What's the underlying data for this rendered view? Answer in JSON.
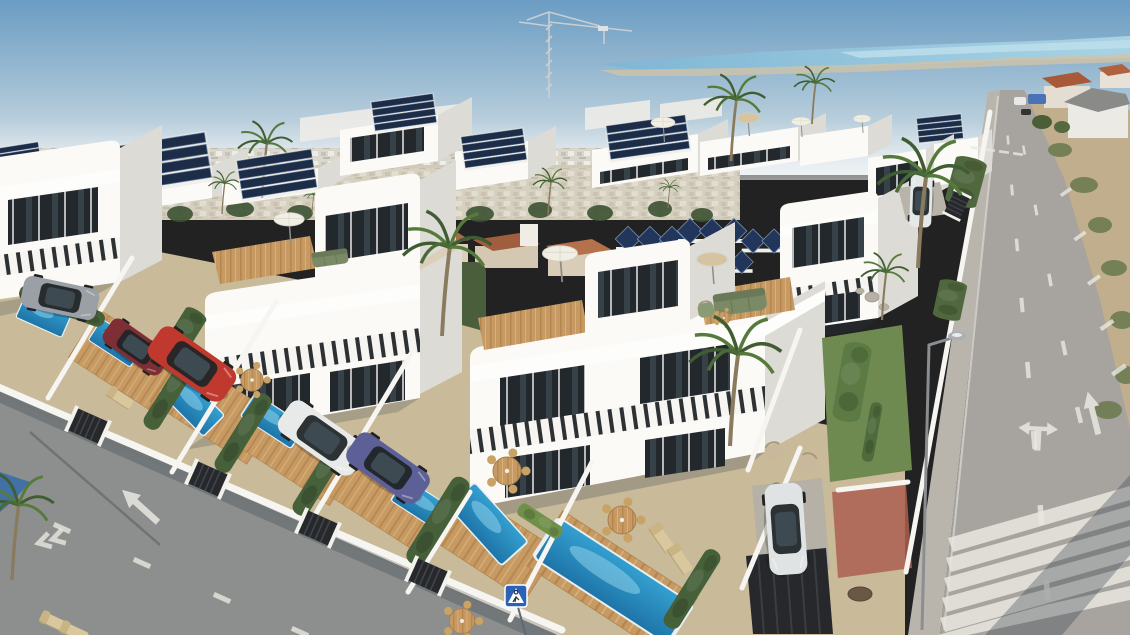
{
  "meta": {
    "description": "Aerial 3D architectural render of a modern white villa development with rooftop solar panels, roof terraces, private pools, parked cars, a long asphalt road with lane arrows and a zebra crossing on the right, and a distant blue coastal lagoon on the horizon.",
    "view": "aerial three-quarter",
    "visible_text": ""
  },
  "palette": {
    "sky_top": "#6B9CC3",
    "sky_mid": "#A7C3D6",
    "horizon": "#E2E8EA",
    "sea": "#8FC2DA",
    "sea_light": "#B2DAE8",
    "shore": "#CFC3A8",
    "city": "#D8D4C8",
    "field": "#7C8A5E",
    "tree_dark": "#3C5232",
    "tan_ground": "#C9BA9A",
    "terracotta": "#AC6A48",
    "road_right": "#A7A4A0",
    "road_left": "#8D8F8E",
    "sidewalk": "#B9B5AC",
    "red_paving": "#AD5F50",
    "sand": "#C2AE8C",
    "villa_white": "#F6F5F1",
    "villa_lit": "#FBFAF7",
    "villa_shade": "#DCDBD5",
    "villa_dark": "#C9C8C1",
    "glass": "#23282C",
    "glass_hi": "#46565F",
    "frame": "#1A1D1F",
    "rail_dark": "#2E3134",
    "wood": "#C79A63",
    "wood_dark": "#B3874F",
    "pool_light": "#2F98C8",
    "pool_deep": "#1E74A8",
    "pool_hi": "#8ED1EA",
    "hedge": "#46603A",
    "grass": "#6A8A47",
    "palm_dark": "#3F5C33",
    "palm_light": "#567A3C",
    "trunk": "#8A7A5E",
    "parasol_white": "#F1EEE4",
    "parasol_tan": "#D8C49C",
    "sofa_green": "#7B8A66",
    "beige": "#C9B89B",
    "solar": "#1D2C47",
    "solar_line": "#5D7696",
    "car_red": "#C0392E",
    "car_maroon": "#7E2F35",
    "car_silver": "#9AA0A6",
    "car_blue": "#5C6096",
    "car_white": "#E8EAEA",
    "shadow": "#2F3C49",
    "marking": "#E9E7E0",
    "sign_blue": "#2B62B8",
    "crane": "#C8CED2"
  },
  "scene_counts": {
    "foreground_villas": 4,
    "back_row_villas": 7,
    "pools": 7,
    "cars": 7,
    "solar_arrays": 12,
    "palm_trees": 15
  },
  "sprites": [
    {
      "k": "palm",
      "x": 40,
      "y": 224,
      "sx": 0.3,
      "l": "back"
    },
    {
      "k": "palm",
      "x": 135,
      "y": 220,
      "sx": 0.3,
      "l": "back"
    },
    {
      "k": "palm",
      "x": 312,
      "y": 214,
      "sx": 0.28,
      "l": "back"
    },
    {
      "k": "palm",
      "x": 668,
      "y": 208,
      "sx": 0.3,
      "l": "back"
    },
    {
      "k": "palm",
      "x": 100,
      "y": 248,
      "sx": 0.5,
      "l": "mid"
    },
    {
      "k": "palm",
      "x": 222,
      "y": 214,
      "sx": 0.45,
      "l": "mid"
    },
    {
      "k": "palm",
      "x": 262,
      "y": 198,
      "sx": 0.8,
      "l": "mid"
    },
    {
      "k": "palm",
      "x": 548,
      "y": 216,
      "sx": 0.5,
      "l": "mid"
    },
    {
      "k": "palm",
      "x": 731,
      "y": 161,
      "sx": 0.9,
      "l": "mid"
    },
    {
      "k": "palm",
      "x": 812,
      "y": 124,
      "sx": 0.6,
      "l": "mid"
    },
    {
      "k": "solar",
      "x": 18,
      "y": 158,
      "sx": 0.5,
      "r": -9,
      "l": "mid"
    },
    {
      "k": "solar",
      "x": 158,
      "y": 164,
      "sx": 1.15,
      "sy": 0.95,
      "r": -9,
      "l": "mid"
    },
    {
      "k": "solar",
      "x": 277,
      "y": 175,
      "sx": 0.85,
      "sy": 0.8,
      "r": -9,
      "l": "mid"
    },
    {
      "k": "solar",
      "x": 404,
      "y": 113,
      "sx": 0.7,
      "sy": 0.6,
      "r": -8,
      "l": "mid"
    },
    {
      "k": "solar",
      "x": 494,
      "y": 149,
      "sx": 0.7,
      "sy": 0.65,
      "r": -8,
      "l": "mid"
    },
    {
      "k": "solar",
      "x": 648,
      "y": 138,
      "sx": 0.9,
      "sy": 0.7,
      "r": -8,
      "l": "mid"
    },
    {
      "k": "solar",
      "x": 940,
      "y": 129,
      "sx": 0.5,
      "sy": 0.5,
      "r": -6,
      "l": "mid"
    },
    {
      "k": "solarzig",
      "x": 650,
      "y": 239,
      "sx": 1,
      "l": "mid"
    },
    {
      "k": "solarzig",
      "x": 712,
      "y": 231,
      "sx": 1,
      "l": "mid"
    },
    {
      "k": "solarzig",
      "x": 774,
      "y": 241,
      "sx": 0.95,
      "l": "mid"
    },
    {
      "k": "solarzig",
      "x": 658,
      "y": 269,
      "sx": 0.95,
      "l": "mid"
    },
    {
      "k": "solarzig",
      "x": 722,
      "y": 262,
      "sx": 0.9,
      "l": "mid"
    },
    {
      "k": "parasol",
      "x": 663,
      "y": 142,
      "sx": 0.75,
      "l": "mid"
    },
    {
      "k": "parasol",
      "x": 748,
      "y": 136,
      "sx": 0.7,
      "c": "#D8C49C",
      "l": "mid"
    },
    {
      "k": "parasol",
      "x": 801,
      "y": 137,
      "sx": 0.6,
      "l": "mid"
    },
    {
      "k": "parasol",
      "x": 862,
      "y": 133,
      "sx": 0.55,
      "l": "mid"
    },
    {
      "k": "deck",
      "x": 128,
      "y": 362,
      "sx": 1.05,
      "sy": 0.95,
      "r": 33,
      "l": "decks"
    },
    {
      "k": "deck",
      "x": 214,
      "y": 409,
      "sx": 1.15,
      "sy": 0.95,
      "r": 33,
      "l": "decks"
    },
    {
      "k": "deck",
      "x": 298,
      "y": 453,
      "sx": 1.1,
      "sy": 0.9,
      "r": 33,
      "l": "decks"
    },
    {
      "k": "deck",
      "x": 384,
      "y": 499,
      "sx": 1.1,
      "sy": 0.9,
      "r": 33,
      "l": "decks"
    },
    {
      "k": "deck",
      "x": 489,
      "y": 541,
      "sx": 1.25,
      "sy": 1.0,
      "r": 33,
      "l": "decks"
    },
    {
      "k": "deck",
      "x": 612,
      "y": 582,
      "sx": 1.6,
      "sy": 1.1,
      "r": 33,
      "l": "decks"
    },
    {
      "k": "pool",
      "x": 44,
      "y": 315,
      "sx": 0.5,
      "sy": 0.45,
      "r": 24,
      "l": "pools"
    },
    {
      "k": "pool",
      "x": 116,
      "y": 343,
      "sx": 0.5,
      "sy": 0.42,
      "r": 33,
      "l": "pools"
    },
    {
      "k": "pool",
      "x": 192,
      "y": 404,
      "sx": 0.62,
      "sy": 0.5,
      "r": 45,
      "l": "pools"
    },
    {
      "k": "pool",
      "x": 273,
      "y": 421,
      "sx": 0.6,
      "sy": 0.45,
      "r": 33,
      "l": "pools"
    },
    {
      "k": "pool",
      "x": 424,
      "y": 506,
      "sx": 0.62,
      "sy": 0.45,
      "r": 33,
      "l": "pools"
    },
    {
      "k": "pool",
      "x": 488,
      "y": 524,
      "sx": 0.8,
      "sy": 0.6,
      "r": 48,
      "l": "pools"
    },
    {
      "k": "pool",
      "x": 613,
      "y": 581,
      "sx": 1.6,
      "sy": 0.8,
      "r": 33,
      "l": "pools"
    },
    {
      "k": "hedge",
      "x": 62,
      "y": 306,
      "sx": 0.9,
      "sy": 0.8,
      "r": 20
    },
    {
      "k": "hedge",
      "x": 185,
      "y": 332,
      "sx": 0.5,
      "sy": 1.2,
      "r": -58
    },
    {
      "k": "hedge",
      "x": 172,
      "y": 390,
      "sx": 0.9,
      "r": -58
    },
    {
      "k": "hedge",
      "x": 243,
      "y": 433,
      "sx": 0.9,
      "r": -58
    },
    {
      "k": "hedge",
      "x": 321,
      "y": 476,
      "sx": 0.9,
      "r": -58
    },
    {
      "k": "hedge",
      "x": 438,
      "y": 521,
      "sx": 1.0,
      "r": -58
    },
    {
      "k": "hedge",
      "x": 692,
      "y": 589,
      "sx": 0.9,
      "r": -58
    },
    {
      "k": "hedge",
      "x": 152,
      "y": 352,
      "sx": 0.6,
      "sy": 0.8,
      "r": 33,
      "c": "#6A8A47"
    },
    {
      "k": "hedge",
      "x": 540,
      "y": 521,
      "sx": 0.5,
      "sy": 0.7,
      "r": 33,
      "c": "#6F9049"
    },
    {
      "k": "hedge",
      "x": 852,
      "y": 382,
      "sx": 0.8,
      "sy": 1.4,
      "r": -80,
      "c": "#5C7A44"
    },
    {
      "k": "hedge",
      "x": 872,
      "y": 432,
      "sx": 0.6,
      "r": -80,
      "c": "#4F6B3C"
    },
    {
      "k": "hedge",
      "x": 966,
      "y": 182,
      "sx": 0.5,
      "sy": 1.6,
      "r": -75,
      "c": "#50683E"
    },
    {
      "k": "hedge",
      "x": 950,
      "y": 300,
      "sx": 0.4,
      "sy": 1.4,
      "r": -78,
      "c": "#50683E"
    },
    {
      "k": "stone",
      "x": 872,
      "y": 297,
      "sx": 1
    },
    {
      "k": "stone",
      "x": 884,
      "y": 307,
      "sx": 0.7
    },
    {
      "k": "stone",
      "x": 860,
      "y": 291,
      "sx": 0.6
    },
    {
      "k": "parasol",
      "x": 289,
      "y": 244,
      "sx": 0.95
    },
    {
      "k": "parasol",
      "x": 560,
      "y": 282,
      "sx": 1.1
    },
    {
      "k": "parasol",
      "x": 712,
      "y": 284,
      "sx": 0.95,
      "c": "#D8C49C"
    },
    {
      "k": "sofa",
      "x": 740,
      "y": 302,
      "sx": 1.1,
      "r": -8
    },
    {
      "k": "armchair",
      "x": 706,
      "y": 310,
      "sx": 0.8,
      "r": -8,
      "c": "#8A9A74"
    },
    {
      "k": "table",
      "x": 724,
      "y": 318,
      "sx": 0.45
    },
    {
      "k": "sofa",
      "x": 330,
      "y": 258,
      "sx": 0.75,
      "r": -8
    },
    {
      "k": "table",
      "x": 252,
      "y": 380,
      "sx": 0.8
    },
    {
      "k": "table",
      "x": 507,
      "y": 471,
      "sx": 1.0
    },
    {
      "k": "table",
      "x": 622,
      "y": 520,
      "sx": 1.0
    },
    {
      "k": "table",
      "x": 462,
      "y": 621,
      "sx": 0.9
    },
    {
      "k": "lounger",
      "x": 318,
      "y": 447,
      "sx": 0.9,
      "r": 33
    },
    {
      "k": "lounger",
      "x": 336,
      "y": 460,
      "sx": 0.9,
      "r": 33
    },
    {
      "k": "lounger",
      "x": 662,
      "y": 538,
      "sx": 0.95,
      "r": 55
    },
    {
      "k": "lounger",
      "x": 680,
      "y": 559,
      "sx": 0.95,
      "r": 55
    },
    {
      "k": "lounger",
      "x": 54,
      "y": 622,
      "sx": 0.9,
      "r": 25
    },
    {
      "k": "lounger",
      "x": 74,
      "y": 632,
      "sx": 0.9,
      "r": 25
    },
    {
      "k": "lounger",
      "x": 120,
      "y": 398,
      "sx": 0.85,
      "r": 33
    },
    {
      "k": "armchair",
      "x": 774,
      "y": 452,
      "sx": 0.9,
      "r": -15
    },
    {
      "k": "armchair",
      "x": 808,
      "y": 463,
      "sx": 0.9,
      "r": 15
    },
    {
      "k": "gate",
      "x": 88,
      "y": 426,
      "r": 24
    },
    {
      "k": "gate",
      "x": 208,
      "y": 479,
      "r": 24
    },
    {
      "k": "gate",
      "x": 318,
      "y": 528,
      "r": 24
    },
    {
      "k": "gate",
      "x": 428,
      "y": 576,
      "r": 24
    },
    {
      "k": "gate",
      "x": 957,
      "y": 205,
      "sx": 0.7,
      "r": -64
    },
    {
      "k": "car",
      "n": "silver-coupe",
      "x": 60,
      "y": 298,
      "sx": 0.8,
      "r": 12,
      "c": "#9AA0A6"
    },
    {
      "k": "car",
      "n": "maroon-car",
      "x": 136,
      "y": 347,
      "sx": 0.72,
      "r": 35,
      "c": "#7E2F35"
    },
    {
      "k": "car",
      "n": "red-suv",
      "x": 192,
      "y": 364,
      "sx": 0.95,
      "r": 35,
      "c": "#C0392E"
    },
    {
      "k": "car",
      "n": "white-sedan",
      "x": 322,
      "y": 438,
      "sx": 0.95,
      "r": 35,
      "c": "#E8EAEA"
    },
    {
      "k": "car",
      "n": "blue-coupe",
      "x": 388,
      "y": 468,
      "sx": 0.9,
      "r": 35,
      "c": "#5C6096"
    },
    {
      "k": "car",
      "n": "white-suv",
      "x": 786,
      "y": 529,
      "sx": 0.95,
      "r": 86,
      "c": "#DFE3E4"
    },
    {
      "k": "car",
      "n": "white-compact",
      "x": 921,
      "y": 201,
      "sx": 0.55,
      "r": -88,
      "c": "#E5E8E8"
    },
    {
      "k": "palm",
      "x": 442,
      "y": 336,
      "sx": 1.3
    },
    {
      "k": "palm",
      "x": 730,
      "y": 446,
      "sx": 1.35
    },
    {
      "k": "palm",
      "x": 918,
      "y": 268,
      "sx": 1.35
    },
    {
      "k": "palm",
      "x": 12,
      "y": 580,
      "sx": 1.1
    },
    {
      "k": "palm",
      "x": 882,
      "y": 320,
      "sx": 0.7
    },
    {
      "k": "arrowup",
      "x": 140,
      "y": 506,
      "sx": 1.1,
      "r": -48
    },
    {
      "k": "chevron",
      "x": 50,
      "y": 540,
      "sx": 1.2,
      "r": -15
    },
    {
      "k": "dash",
      "x": 62,
      "y": 528,
      "r": 24
    },
    {
      "k": "dash",
      "x": 142,
      "y": 563,
      "r": 24
    },
    {
      "k": "dash",
      "x": 222,
      "y": 598,
      "r": 24
    },
    {
      "k": "dash",
      "x": 300,
      "y": 632,
      "r": 24
    },
    {
      "k": "arrowfork",
      "x": 1038,
      "y": 433,
      "sx": 1.1,
      "r": 3
    },
    {
      "k": "arrowup",
      "x": 1093,
      "y": 413,
      "sx": 1.0,
      "r": -14
    },
    {
      "k": "dash",
      "x": 1008,
      "y": 140,
      "sx": 0.5,
      "r": 85
    },
    {
      "k": "dash",
      "x": 1012,
      "y": 190,
      "sx": 0.6,
      "r": 85
    },
    {
      "k": "dash",
      "x": 1017,
      "y": 245,
      "sx": 0.7,
      "r": 85
    },
    {
      "k": "dash",
      "x": 1022,
      "y": 305,
      "sx": 0.8,
      "r": 85
    },
    {
      "k": "dash",
      "x": 1028,
      "y": 370,
      "sx": 0.9,
      "r": 85
    },
    {
      "k": "dash",
      "x": 1034,
      "y": 440,
      "sx": 1.0,
      "r": 85
    },
    {
      "k": "dash",
      "x": 1041,
      "y": 515,
      "sx": 1.1,
      "r": 85
    },
    {
      "k": "dash",
      "x": 1047,
      "y": 590,
      "sx": 1.1,
      "r": 85
    },
    {
      "k": "dash",
      "x": 1024,
      "y": 150,
      "sx": 0.5,
      "r": 80
    },
    {
      "k": "dash",
      "x": 1036,
      "y": 210,
      "sx": 0.6,
      "r": 80
    },
    {
      "k": "dash",
      "x": 1050,
      "y": 280,
      "sx": 0.7,
      "r": 80
    },
    {
      "k": "dash",
      "x": 1064,
      "y": 348,
      "sx": 0.8,
      "r": 78
    },
    {
      "k": "dash",
      "x": 1079,
      "y": 415,
      "sx": 0.9,
      "r": 76
    },
    {
      "k": "dash",
      "x": 1066,
      "y": 192,
      "sx": 0.7,
      "r": -35
    },
    {
      "k": "dash",
      "x": 1080,
      "y": 236,
      "sx": 0.75,
      "r": -35
    },
    {
      "k": "dash",
      "x": 1094,
      "y": 280,
      "sx": 0.8,
      "r": -35
    },
    {
      "k": "dash",
      "x": 1107,
      "y": 325,
      "sx": 0.85,
      "r": -35
    },
    {
      "k": "dash",
      "x": 1119,
      "y": 370,
      "sx": 0.9,
      "r": -35
    },
    {
      "k": "dash",
      "x": 976,
      "y": 148,
      "sx": 0.55,
      "r": 8
    },
    {
      "k": "dash",
      "x": 990,
      "y": 150,
      "sx": 0.55,
      "r": 8
    },
    {
      "k": "dash",
      "x": 1004,
      "y": 152,
      "sx": 0.55,
      "r": 8
    },
    {
      "k": "dash",
      "x": 1018,
      "y": 154,
      "sx": 0.55,
      "r": 8
    },
    {
      "k": "signped",
      "x": 516,
      "y": 596,
      "sx": 1,
      "l": "overlay"
    }
  ]
}
